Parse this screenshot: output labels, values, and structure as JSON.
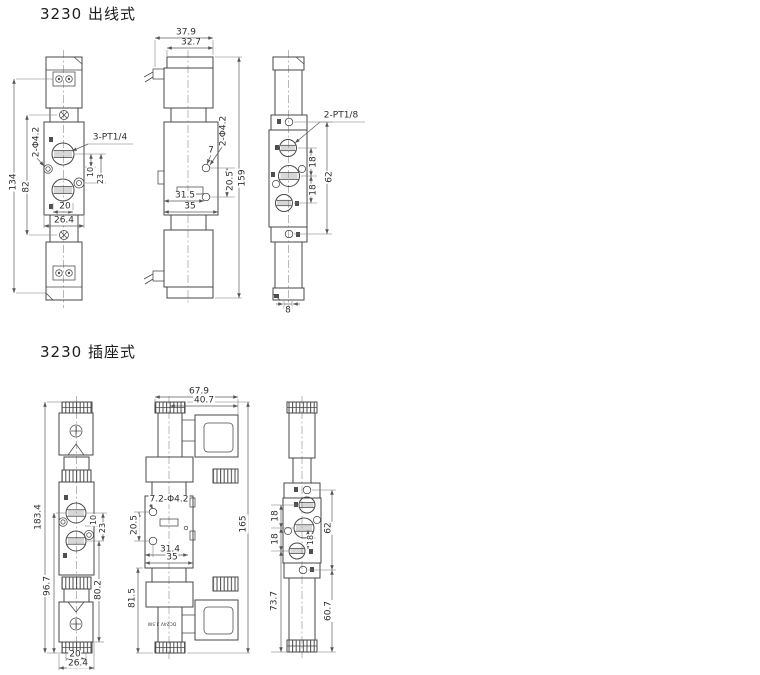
{
  "colors": {
    "background": "#ffffff",
    "line": "#474747",
    "dimension_line": "#5c5c5c",
    "text": "#2e2e2e"
  },
  "s1": {
    "title": "3230 出线式",
    "front": {
      "d134": "134",
      "d82": "82",
      "hole_label": "2-Φ4.2",
      "port_label": "3-PT1/4",
      "d10": "10",
      "d23": "23",
      "d20": "20",
      "d26_4": "26.4"
    },
    "side": {
      "d37_9": "37.9",
      "d32_7": "32.7",
      "d7": "7",
      "hole_label": "2-Φ4.2",
      "d20_5": "20.5",
      "d159": "159",
      "d31_5": "31.5",
      "d35": "35"
    },
    "back": {
      "port_label": "2-PT1/8",
      "d18_top": "18",
      "d18_bottom": "18",
      "d62": "62",
      "d8": "8"
    }
  },
  "s2": {
    "title": "3230 插座式",
    "front": {
      "d183_4": "183.4",
      "d96_7": "96.7",
      "d80_2": "80.2",
      "d10": "10",
      "d23": "23",
      "d20": "20",
      "d26_4": "26.4"
    },
    "side": {
      "d67_9": "67.9",
      "d40_7": "40.7",
      "hole_label": "7.2-Φ4.2",
      "d20_5": "20.5",
      "d31_4": "31.4",
      "d35": "35",
      "d81_5": "81.5",
      "d165": "165",
      "coil_label": "DC24V 3.5W"
    },
    "back": {
      "d18_top": "18",
      "d18_mid": "18",
      "d18_inner": "18",
      "d62": "62",
      "d73_7": "73.7",
      "d60_7": "60.7"
    }
  }
}
